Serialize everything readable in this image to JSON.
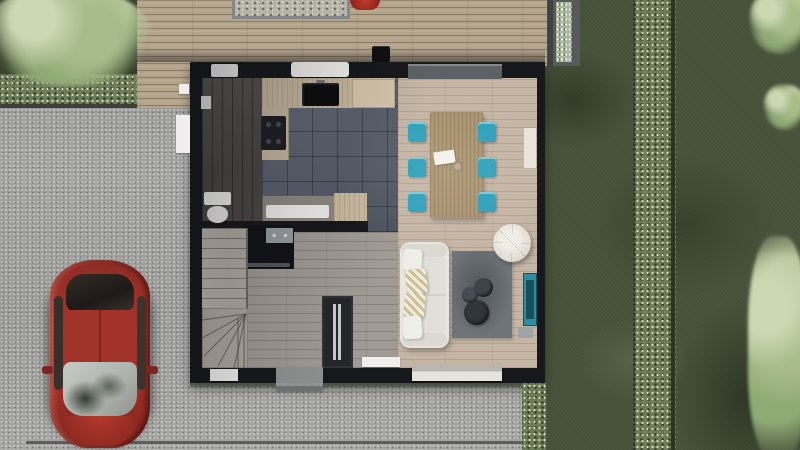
{
  "scene": {
    "title": "Aerial top-down 3D render of a house ground floor plan with garden, wood deck, gravel driveway and a red car",
    "outdoor": {
      "driveway": "gravel",
      "deck": "wood plank terrace with planter boxes",
      "lawn": "dark green grass with hedge strips",
      "trees": 4,
      "vehicle": "red hatchback car parked facing the street"
    },
    "house": {
      "rooms": [
        {
          "name": "kitchen",
          "floor": "dark grey tile",
          "features": [
            "sink",
            "cooktop",
            "island with trough sink"
          ]
        },
        {
          "name": "wc-utility",
          "floor": "dark wood",
          "features": [
            "toilet"
          ]
        },
        {
          "name": "dining-room",
          "floor": "light wood",
          "features": [
            "wood table",
            "6 teal chairs",
            "paper",
            "bowl"
          ]
        },
        {
          "name": "living-room",
          "floor": "light wood",
          "features": [
            "white sofa",
            "grey rug",
            "3 round coffee tables",
            "round pouf",
            "teal media console"
          ]
        },
        {
          "name": "entry-hall",
          "floor": "grey wood",
          "features": [
            "wardrobe",
            "porch step"
          ]
        },
        {
          "name": "staircase",
          "floor": "light treads, winder turn"
        },
        {
          "name": "storage-closet",
          "floor": "black"
        }
      ],
      "furniture_counts": {
        "dining_chairs": 6,
        "coffee_tables": 3,
        "sofa_pillows": 4
      }
    }
  },
  "colors": {
    "gravel": "#9b9b99",
    "grass_dark": "#39422e",
    "lawn": "#49543c",
    "hedge": "#6e7d59",
    "deck": "#b3a48b",
    "wall": "#17181b",
    "tile": "#5b6370",
    "wood_floor": "#c4b5a5",
    "hall_floor": "#a09a94",
    "wc_floor": "#4b4744",
    "counter": "#c6b79f",
    "stairs": "#b2aba3",
    "table": "#a9946f",
    "chair": "#2ba0ba",
    "sofa": "#e9e6e1",
    "rug": "#6e747a",
    "coffee_table": "#31363d",
    "pouf": "#ddd8ce",
    "console": "#2d8ea2",
    "car": "#a83329",
    "door": "#24262a",
    "sill": "#efeeec"
  }
}
